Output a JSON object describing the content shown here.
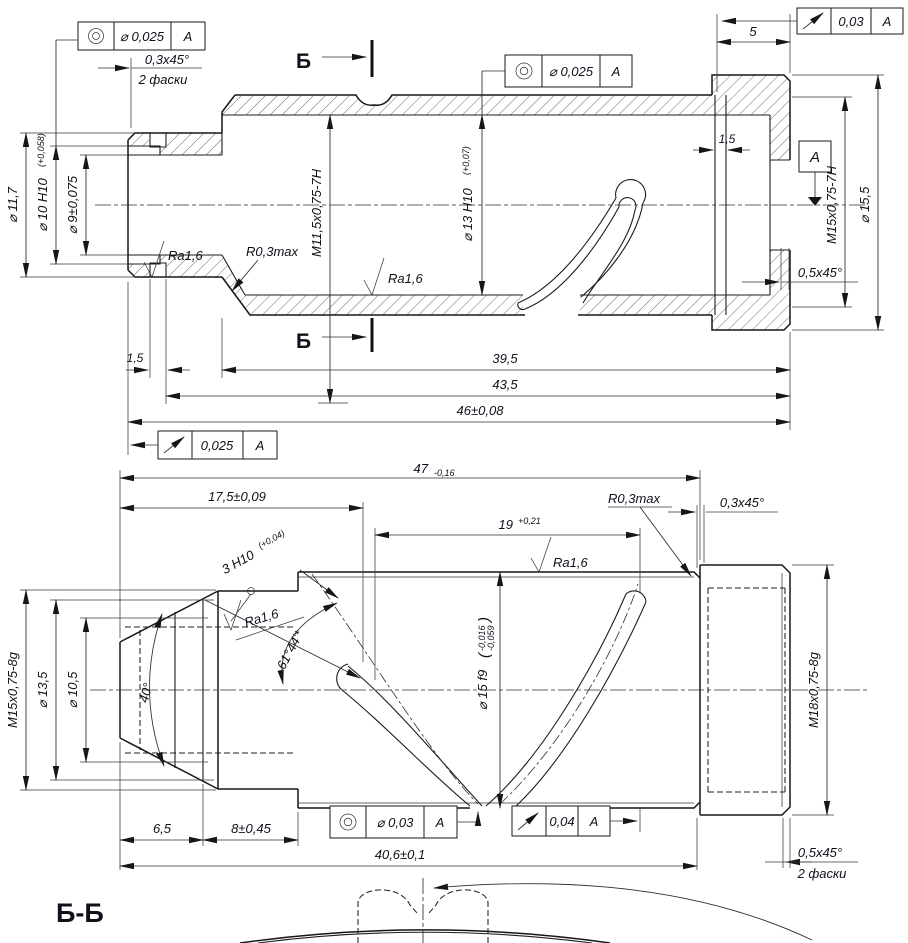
{
  "labels": {
    "datum": "A",
    "conc_val": "⌀ 0,025",
    "conc_val2": "⌀ 0,03",
    "runout_tr": "0,03",
    "runout_bl": "0,025",
    "runout_br": "0,04",
    "chamfer03": "0,3x45°",
    "chamfer05": "0,5x45°",
    "two_chamfers": "2 фаски",
    "section": "Б",
    "section_view": "Б-Б",
    "dia117": "⌀ 11,7",
    "dia10": "⌀ 10 H10",
    "dia10_tol": "(+0,058)",
    "dia9": "⌀ 9±0,075",
    "m115": "M11,5x0,75-7H",
    "ra16": "Ra1,6",
    "r03max": "R0,3max",
    "dia13": "⌀ 13 H10",
    "dia13_tol": "(+0,07)",
    "d15": "1,5",
    "m15_7h": "M15x0,75-7H",
    "dia155": "⌀ 15,5",
    "d5": "5",
    "d395": "39,5",
    "d435": "43,5",
    "d46": "46±0,08",
    "d47": "47",
    "d47_tol": "-0,16",
    "d175": "17,5±0,09",
    "d19": "19",
    "d19_tol": "+0,21",
    "h3": "3 H10",
    "h3_tol": "(+0,04)",
    "ang61": "61°44'*",
    "ang40": "40°",
    "dia15f9": "⌀ 15 f9",
    "f9_hi": "-0,016",
    "f9_lo": "-0,059",
    "po": "(",
    "pc": ")",
    "m15_8g": "M15x0,75-8g",
    "dia135": "⌀ 13,5",
    "dia105": "⌀ 10,5",
    "m18": "M18x0,75-8g",
    "d65": "6,5",
    "d8": "8±0,45",
    "d406": "40,6±0,1"
  }
}
